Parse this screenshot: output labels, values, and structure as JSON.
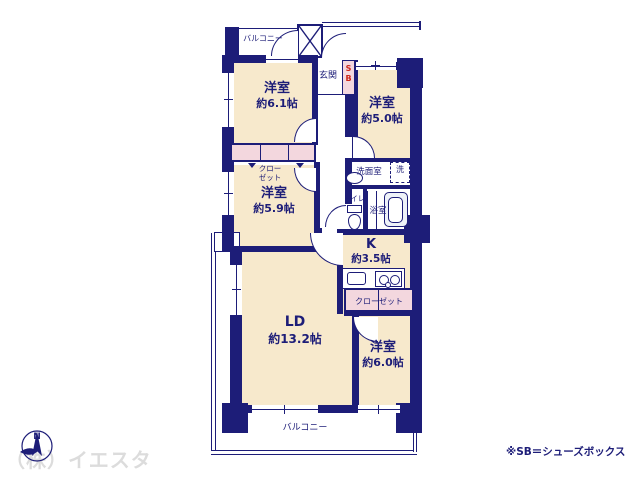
{
  "colors": {
    "wall": "#1d1d78",
    "ink": "#1d1d78",
    "room_fill": "#f7e9cc",
    "closet_fill": "#f3d7de",
    "accent_red": "#cc2418",
    "watermark": "#dcdcdc",
    "fixture": "#eef2f8"
  },
  "rooms": {
    "bedroom_61": {
      "label": "洋室",
      "size": "約6.1帖"
    },
    "bedroom_50": {
      "label": "洋室",
      "size": "約5.0帖"
    },
    "bedroom_59": {
      "label": "洋室",
      "size": "約5.9帖"
    },
    "living_dining": {
      "label": "LD",
      "size": "約13.2帖"
    },
    "kitchen": {
      "label": "K",
      "size": "約3.5帖"
    },
    "bedroom_60": {
      "label": "洋室",
      "size": "約6.0帖"
    }
  },
  "labels": {
    "balcony_top": "バルコニー",
    "balcony_bottom": "バルコニー",
    "entrance": "玄関",
    "shoe_box": "SB",
    "closet_upper_line1": "クロー",
    "closet_upper_line2": "ゼット",
    "closet_lower": "クローゼット",
    "washroom": "洗面室",
    "washing_machine": "洗",
    "toilet": "トイレ",
    "bathroom": "浴室"
  },
  "annotations": {
    "footnote": "※SB＝シューズボックス",
    "watermark": "（株）イエスタ",
    "compass_north": "N"
  }
}
